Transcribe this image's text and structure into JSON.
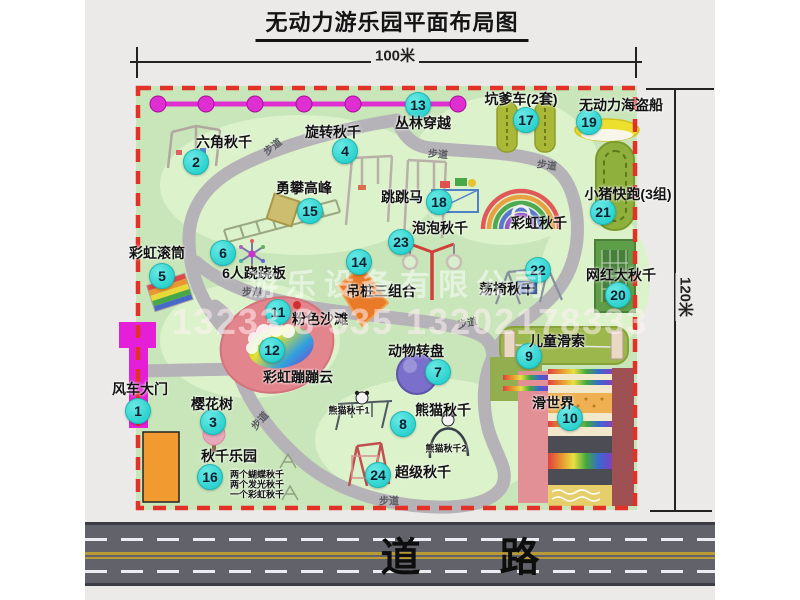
{
  "title": "无动力游乐园平面布局图",
  "dimension_width": "100米",
  "dimension_height": "120米",
  "road_label": "道 路",
  "rest_area_label": "休憩区",
  "watermark": {
    "company": "游乐设备有限公司",
    "phone": "13233 8 535 13202178333"
  },
  "map": {
    "attractions": [
      {
        "num": "1",
        "name": "风车大门",
        "bx": 138,
        "by": 411,
        "lx": 140,
        "ly": 389
      },
      {
        "num": "2",
        "name": "六角秋千",
        "bx": 196,
        "by": 162,
        "lx": 224,
        "ly": 142
      },
      {
        "num": "3",
        "name": "樱花树",
        "bx": 213,
        "by": 422,
        "lx": 212,
        "ly": 404
      },
      {
        "num": "4",
        "name": "旋转秋千",
        "bx": 345,
        "by": 151,
        "lx": 333,
        "ly": 132
      },
      {
        "num": "5",
        "name": "彩虹滚筒",
        "bx": 162,
        "by": 276,
        "lx": 157,
        "ly": 253
      },
      {
        "num": "6",
        "name": "6人跷跷板",
        "bx": 223,
        "by": 253,
        "lx": 254,
        "ly": 273
      },
      {
        "num": "7",
        "name": "动物转盘",
        "bx": 438,
        "by": 372,
        "lx": 416,
        "ly": 351
      },
      {
        "num": "8",
        "name": "熊猫秋千",
        "bx": 403,
        "by": 424,
        "lx": 443,
        "ly": 410
      },
      {
        "num": "9",
        "name": "儿童滑索",
        "bx": 529,
        "by": 356,
        "lx": 557,
        "ly": 341
      },
      {
        "num": "10",
        "name": "滑世界",
        "bx": 570,
        "by": 418,
        "lx": 553,
        "ly": 403
      },
      {
        "num": "11",
        "name": "粉色沙滩",
        "bx": 278,
        "by": 312,
        "lx": 320,
        "ly": 319
      },
      {
        "num": "12",
        "name": "彩虹蹦蹦云",
        "bx": 272,
        "by": 350,
        "lx": 298,
        "ly": 377
      },
      {
        "num": "13",
        "name": "丛林穿越",
        "bx": 418,
        "by": 105,
        "lx": 423,
        "ly": 123
      },
      {
        "num": "14",
        "name": "吊桩三组合",
        "bx": 359,
        "by": 262,
        "lx": 381,
        "ly": 291
      },
      {
        "num": "15",
        "name": "勇攀高峰",
        "bx": 310,
        "by": 211,
        "lx": 304,
        "ly": 188
      },
      {
        "num": "16",
        "name": "秋千乐园",
        "bx": 210,
        "by": 477,
        "lx": 229,
        "ly": 456
      },
      {
        "num": "17",
        "name": "坑爹车(2套)",
        "bx": 526,
        "by": 120,
        "lx": 521,
        "ly": 99
      },
      {
        "num": "18",
        "name": "跳跳马",
        "bx": 439,
        "by": 202,
        "lx": 402,
        "ly": 197
      },
      {
        "num": "19",
        "name": "无动力海盗船",
        "bx": 589,
        "by": 122,
        "lx": 621,
        "ly": 105
      },
      {
        "num": "20",
        "name": "网红大秋千",
        "bx": 618,
        "by": 295,
        "lx": 621,
        "ly": 275
      },
      {
        "num": "21",
        "name": "小猪快跑(3组)",
        "bx": 603,
        "by": 212,
        "lx": 628,
        "ly": 194
      },
      {
        "num": "22",
        "name": "荡椅秋千",
        "bx": 538,
        "by": 270,
        "lx": 507,
        "ly": 289
      },
      {
        "num": "23",
        "name": "泡泡秋千",
        "bx": 401,
        "by": 242,
        "lx": 440,
        "ly": 228
      },
      {
        "num": "24",
        "name": "超级秋千",
        "bx": 378,
        "by": 475,
        "lx": 423,
        "ly": 472
      }
    ],
    "extra_labels": [
      {
        "text": "彩虹秋千",
        "x": 539,
        "y": 223,
        "size": 14
      },
      {
        "text": "熊猫秋千1",
        "x": 349,
        "y": 410,
        "size": 9
      },
      {
        "text": "熊猫秋千2",
        "x": 446,
        "y": 448,
        "size": 9
      },
      {
        "text": "两个蝴蝶秋千",
        "x": 257,
        "y": 474,
        "size": 9
      },
      {
        "text": "两个发光秋千",
        "x": 257,
        "y": 484,
        "size": 9
      },
      {
        "text": "一个彩虹秋千",
        "x": 257,
        "y": 494,
        "size": 9
      }
    ],
    "path_labels": [
      {
        "text": "步道",
        "x": 272,
        "y": 146,
        "rot": -38
      },
      {
        "text": "步道",
        "x": 438,
        "y": 153,
        "rot": 5
      },
      {
        "text": "步道",
        "x": 547,
        "y": 164,
        "rot": 8
      },
      {
        "text": "步道",
        "x": 252,
        "y": 291,
        "rot": 0
      },
      {
        "text": "步道",
        "x": 467,
        "y": 322,
        "rot": -12
      },
      {
        "text": "步道",
        "x": 259,
        "y": 420,
        "rot": -48
      },
      {
        "text": "步道",
        "x": 389,
        "y": 500,
        "rot": 0
      }
    ]
  }
}
